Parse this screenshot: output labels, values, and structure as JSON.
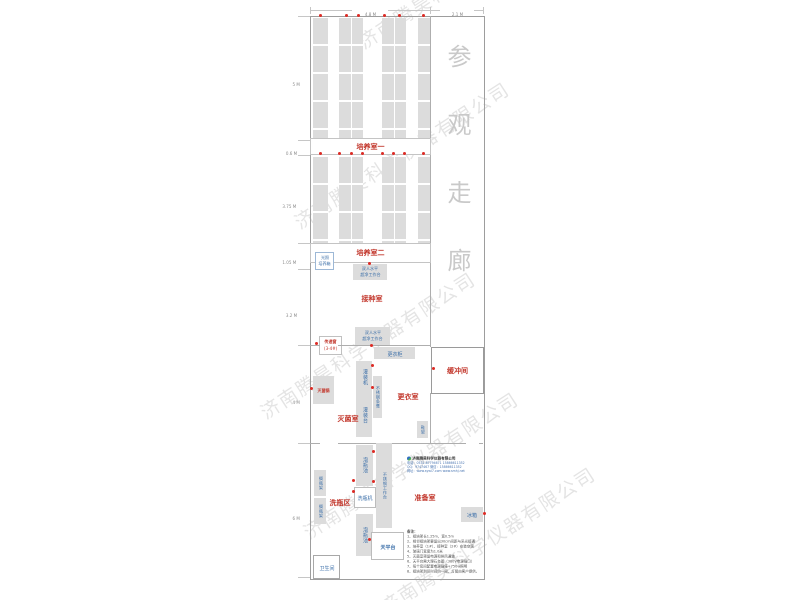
{
  "watermark": {
    "text": "济南腾昊科学仪器有限公司"
  },
  "dimensions": {
    "top": {
      "main": "4.8 M",
      "corridor": "2.1 M"
    },
    "left": [
      "5 M",
      "0.6 M",
      "3.75 M",
      "1.05 M",
      "3.2 M",
      "4 M",
      "6 M"
    ]
  },
  "corridor": {
    "label": "参观走廊"
  },
  "rooms": {
    "culture1": "培养室一",
    "culture2": "培养室二",
    "inoculation": "接种室",
    "sterilization": "灭菌室",
    "changing": "更衣室",
    "buffer": "缓冲间",
    "washing_area": "洗瓶区",
    "preparation": "准备室"
  },
  "equipment": {
    "light_incubator_l1": "光照",
    "light_incubator_l2": "培养箱",
    "clean_bench_l1": "双人水平",
    "clean_bench_l2": "超净工作台",
    "transfer_window_l1": "传递窗",
    "transfer_window_l2": "(3-4#)",
    "wardrobe": "更衣柜",
    "autoclave": "灭菌锅",
    "filling_machine": "灌装机",
    "steel_bench": "不锈钢条凳",
    "filling_table": "灌装台",
    "shoe_rack": "鞋架",
    "soak_pool": "泡瓶池",
    "bottle_washer": "洗瓶机",
    "steel_worktable": "不锈钢工作台",
    "bottle_rack": "搁瓶架",
    "balance_table": "天平台",
    "fridge": "冰箱",
    "toilet": "卫生间"
  },
  "company": {
    "name": "济南腾昊科学仪器有限公司",
    "tel": "电话：0531-87794671  15866611352",
    "qq": "QQ：9747467  微信：15866611352",
    "web": "网址：www.sywl7.com  www.smhj.net"
  },
  "notes": {
    "title": "备注：",
    "items": [
      "1、组培架长1.25m，宽0.5m",
      "2、相邻组培架要留出30cm间距与采光接通",
      "3、培养室（1#）、接种室（2#）安装空调",
      "4、玻璃门宽度为1.0米",
      "5、灭菌室预留电源和排风通道",
      "6、天平台需大理石台面（380V电源插口）",
      "7、每个房间配置电源插座+750w照明",
      "8、组培架到货时间约一周，灯管由客户提供。"
    ]
  }
}
